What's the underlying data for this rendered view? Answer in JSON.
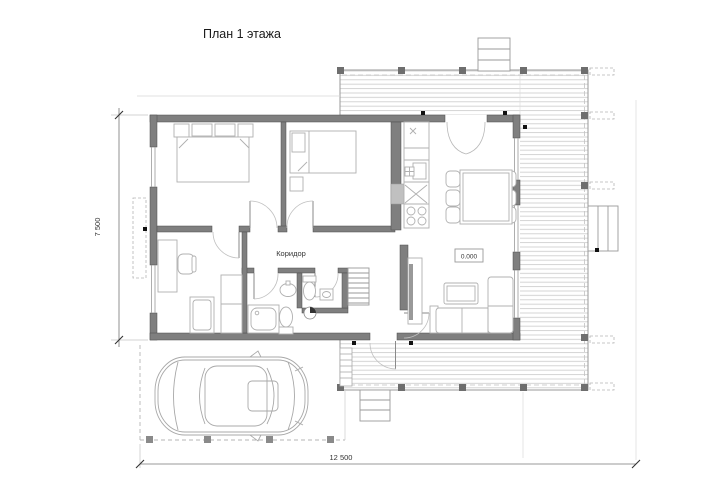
{
  "title": "План 1 этажа",
  "labels": {
    "corridor": "Коридор",
    "elevation": "0.000"
  },
  "dimensions": {
    "width_total": "12 500",
    "height_total": "7 500"
  },
  "colors": {
    "background": "#ffffff",
    "wall": "#7f7f7f",
    "furniture_line": "#b0b0b0",
    "deck_plank": "#cfcfcf",
    "dashed_line": "#b5b5b5",
    "dimension_line": "#666666",
    "text": "#1a1a1a"
  }
}
